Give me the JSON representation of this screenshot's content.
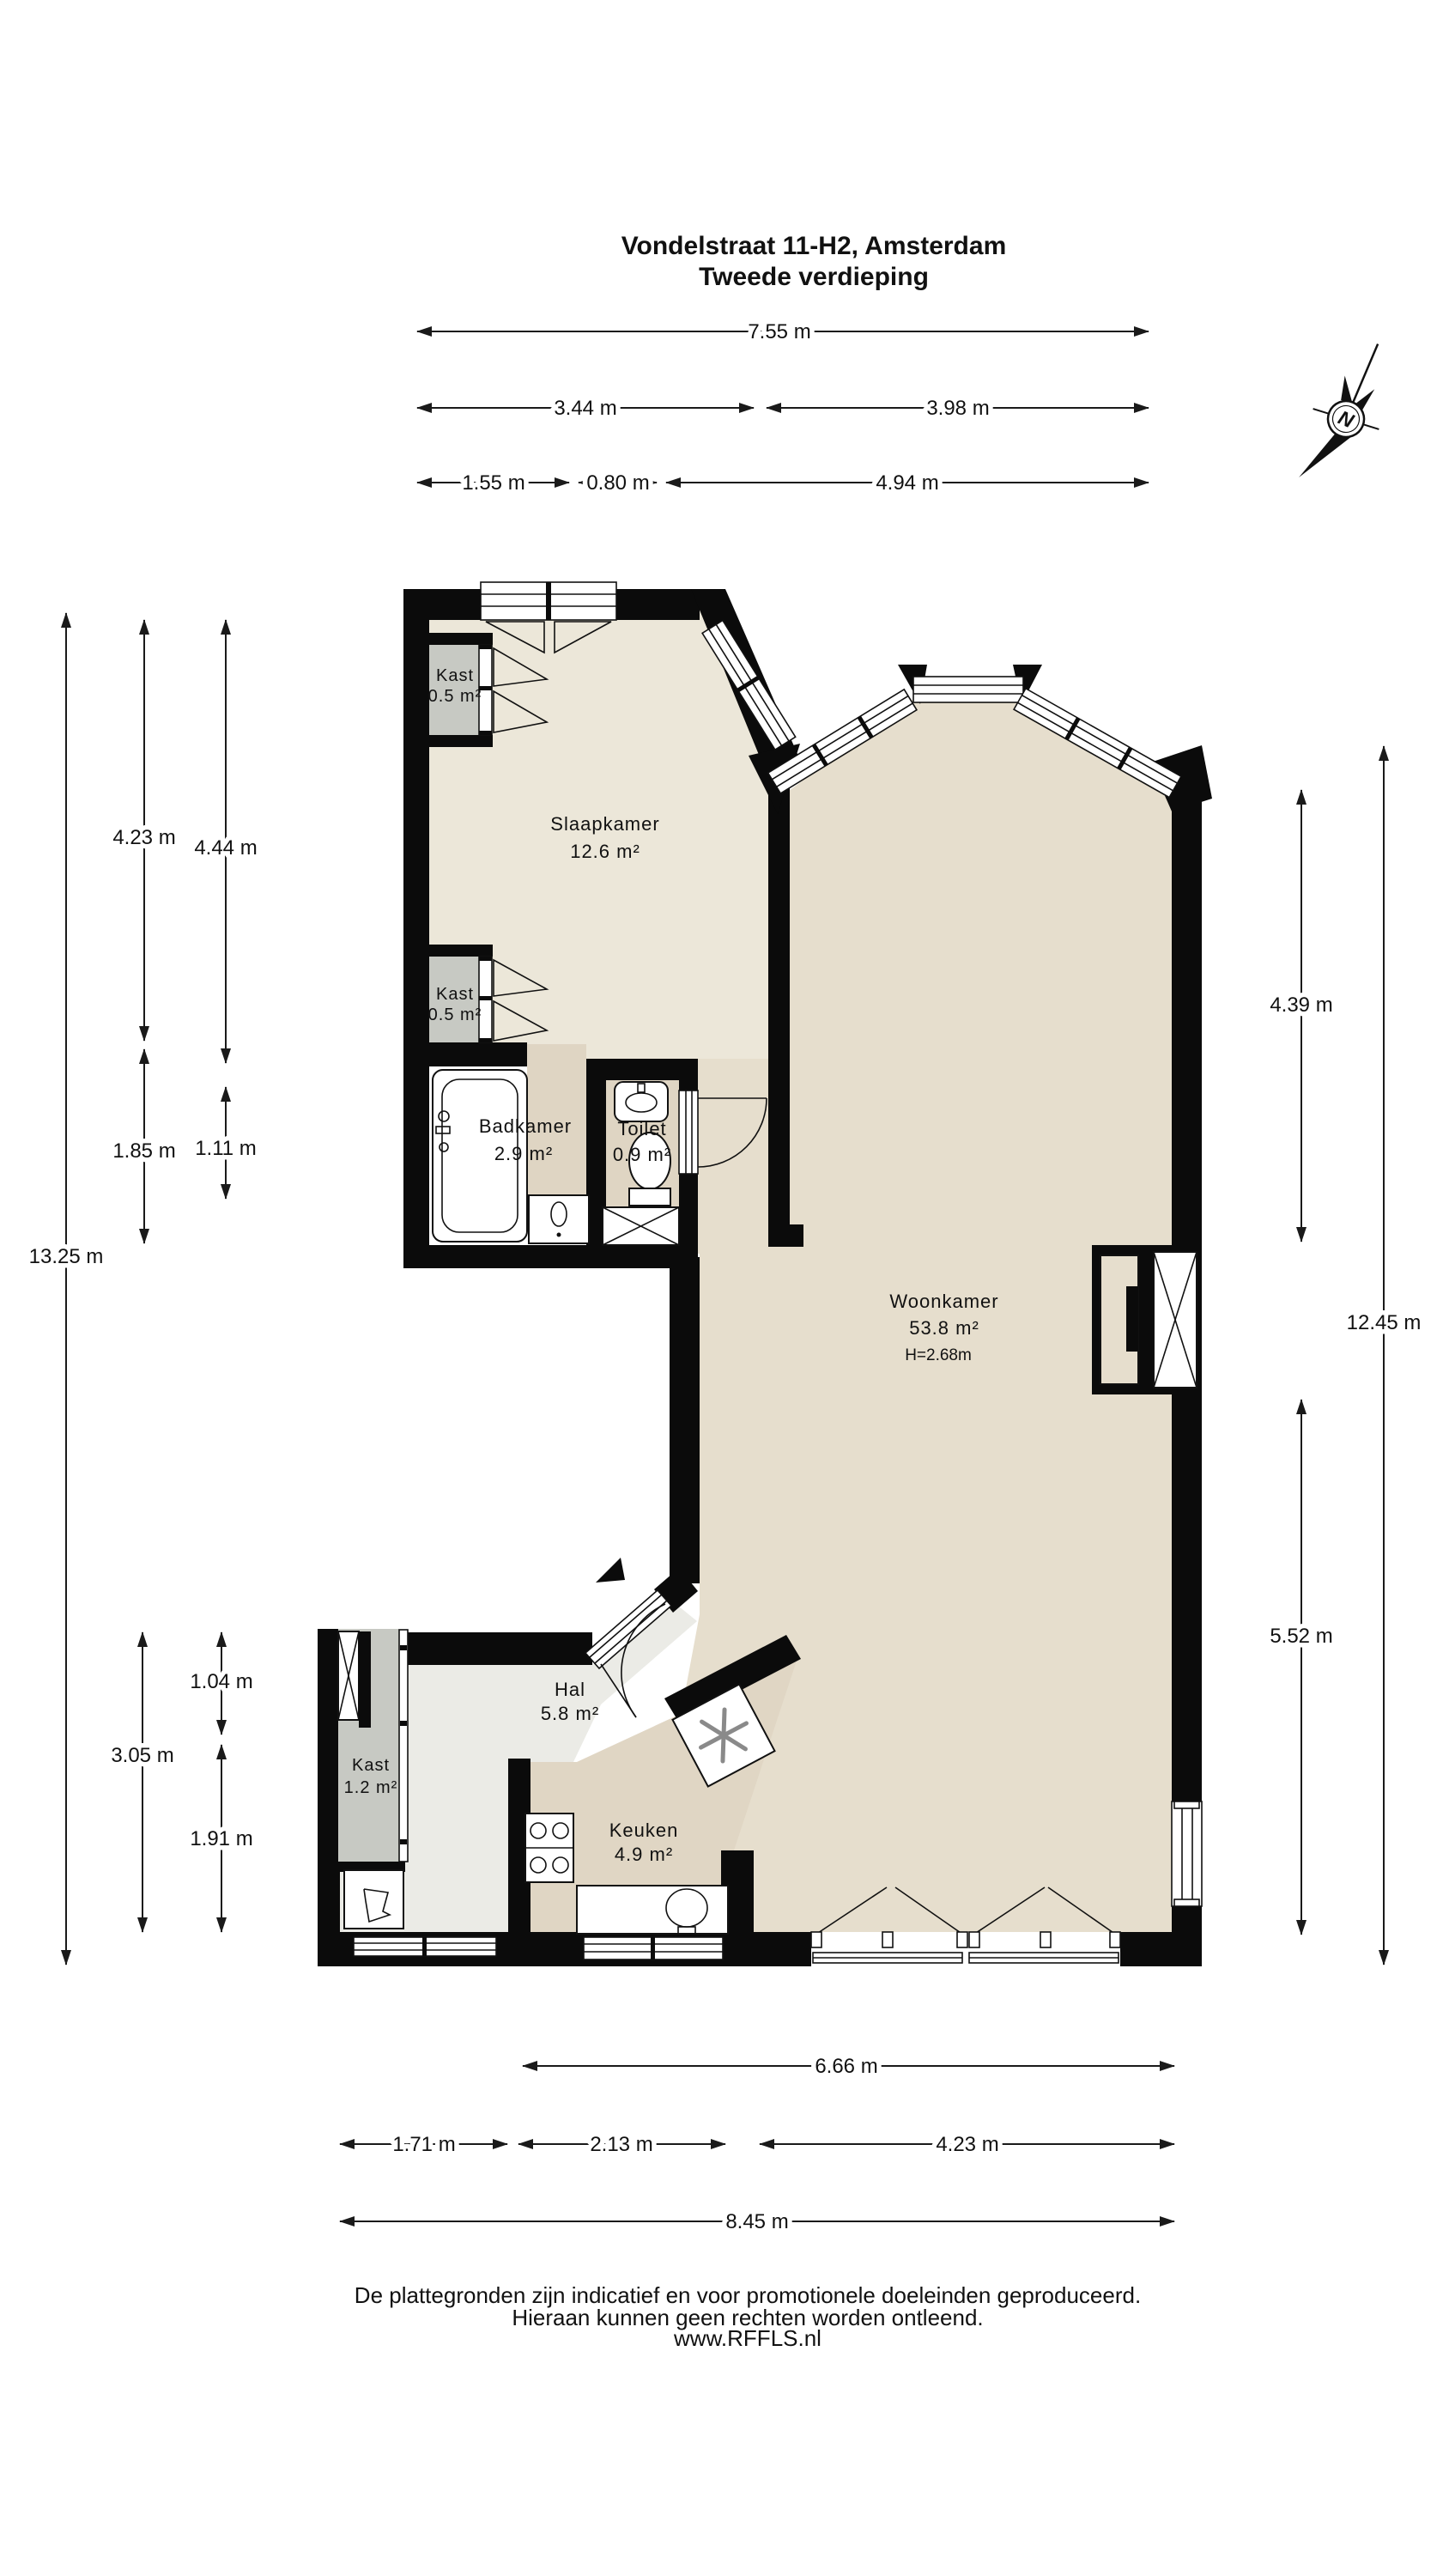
{
  "title": {
    "line1": "Vondelstraat 11-H2, Amsterdam",
    "line2": "Tweede verdieping"
  },
  "compass": {
    "letter": "N"
  },
  "rooms": {
    "slaapkamer": {
      "name": "Slaapkamer",
      "area": "12.6 m²"
    },
    "woonkamer": {
      "name": "Woonkamer",
      "area": "53.8 m²",
      "ceiling": "H=2.68m"
    },
    "badkamer": {
      "name": "Badkamer",
      "area": "2.9 m²"
    },
    "toilet": {
      "name": "Toilet",
      "area": "0.9 m²"
    },
    "hal": {
      "name": "Hal",
      "area": "5.8 m²"
    },
    "keuken": {
      "name": "Keuken",
      "area": "4.9 m²"
    },
    "kast_slaapkamer_boven": {
      "name": "Kast",
      "area": "0.5 m²"
    },
    "kast_slaapkamer_onder": {
      "name": "Kast",
      "area": "0.5 m²"
    },
    "kast_hal": {
      "name": "Kast",
      "area": "1.2 m²"
    }
  },
  "dimensions": {
    "top": [
      "7.55 m",
      "3.44 m",
      "3.98 m",
      "1.55 m",
      "0.80 m",
      "4.94 m"
    ],
    "left": [
      "13.25 m",
      "4.23 m",
      "1.85 m",
      "4.44 m",
      "1.11 m",
      "1.04 m",
      "3.05 m",
      "1.91 m"
    ],
    "right": [
      "4.39 m",
      "12.45 m",
      "5.52 m"
    ],
    "bottom": [
      "6.66 m",
      "1.71 m",
      "2.13 m",
      "4.23 m",
      "8.45 m"
    ]
  },
  "footer": {
    "line1": "De plattegronden zijn indicatief en voor promotionele doeleinden geproduceerd.",
    "line2": "Hieraan kunnen geen rechten worden ontleend.",
    "line3": "www.RFFLS.nl"
  }
}
